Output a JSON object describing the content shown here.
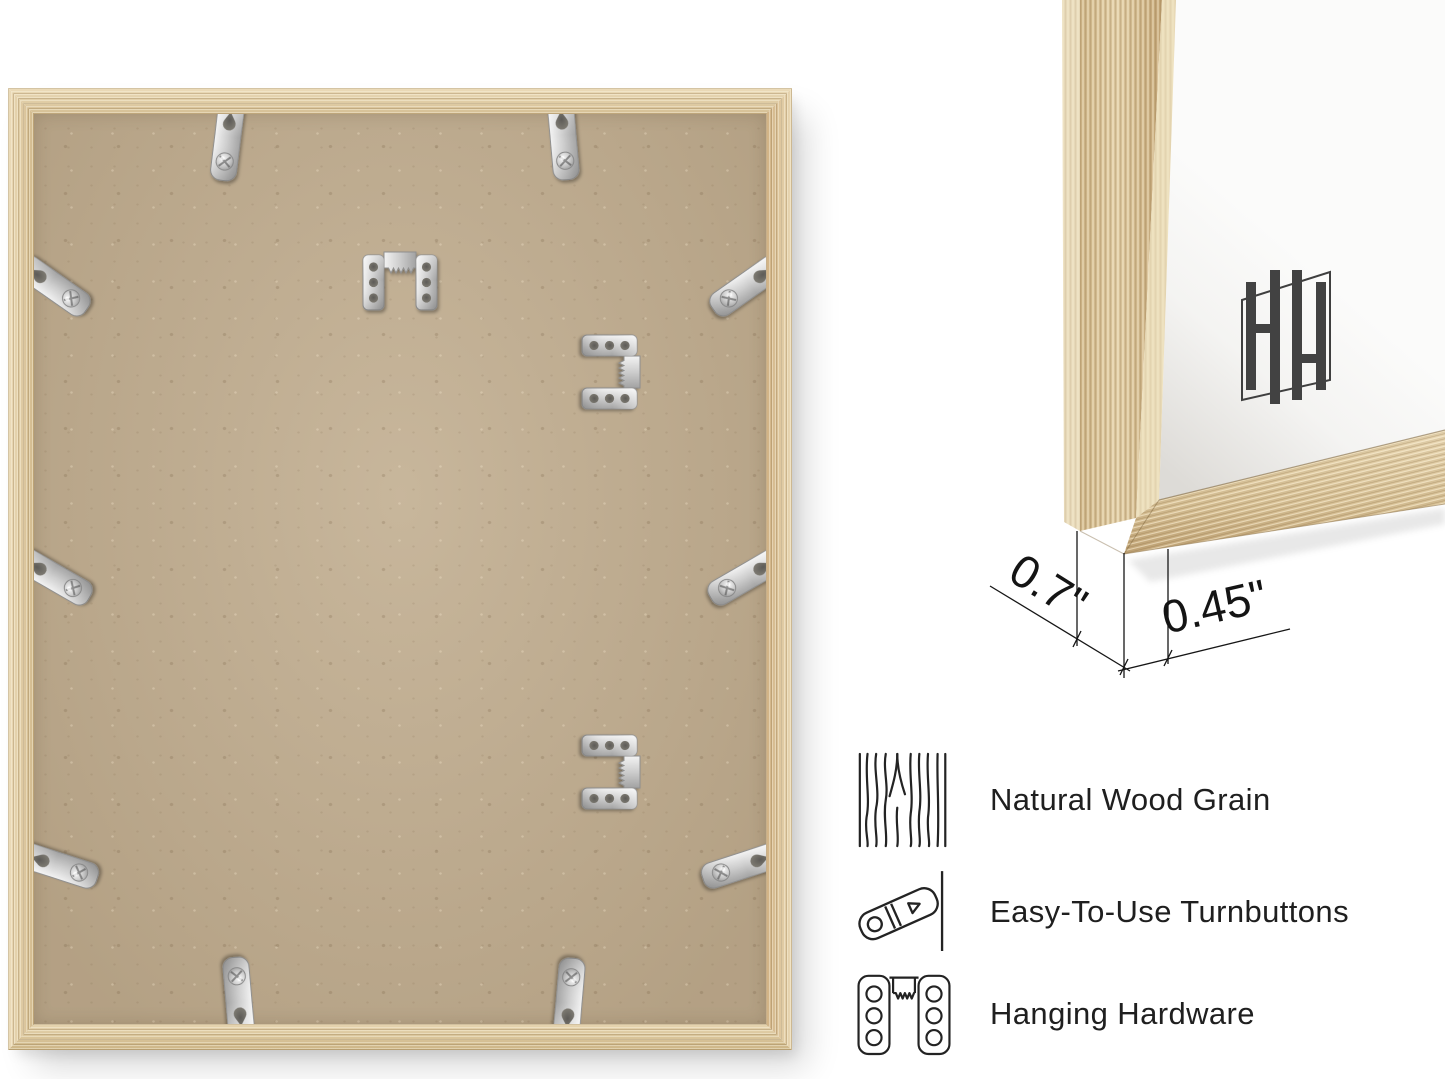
{
  "dimensions": {
    "depth": "0.7\"",
    "face": "0.45\""
  },
  "features": [
    {
      "icon": "wood-grain-icon",
      "label": "Natural Wood Grain"
    },
    {
      "icon": "turnbutton-icon",
      "label": "Easy-To-Use Turnbuttons"
    },
    {
      "icon": "hanging-hardware-icon",
      "label": "Hanging Hardware"
    }
  ],
  "photos": {
    "back": {
      "name": "frame-back-photo",
      "turnbutton_count": 10,
      "sawtooth_hanger_count": 3
    },
    "corner": {
      "name": "frame-corner-closeup",
      "logo": "hh-monogram-logo"
    }
  },
  "colors": {
    "wood": "#dcc69e",
    "wood_dark": "#b9986a",
    "wood_light": "#eee0c0",
    "backing": "#c0ad90",
    "metal": "#d6d6d6",
    "mat": "#fbfbfa",
    "ink": "#1b1b1b",
    "logo_ink": "#3f3f3f"
  }
}
